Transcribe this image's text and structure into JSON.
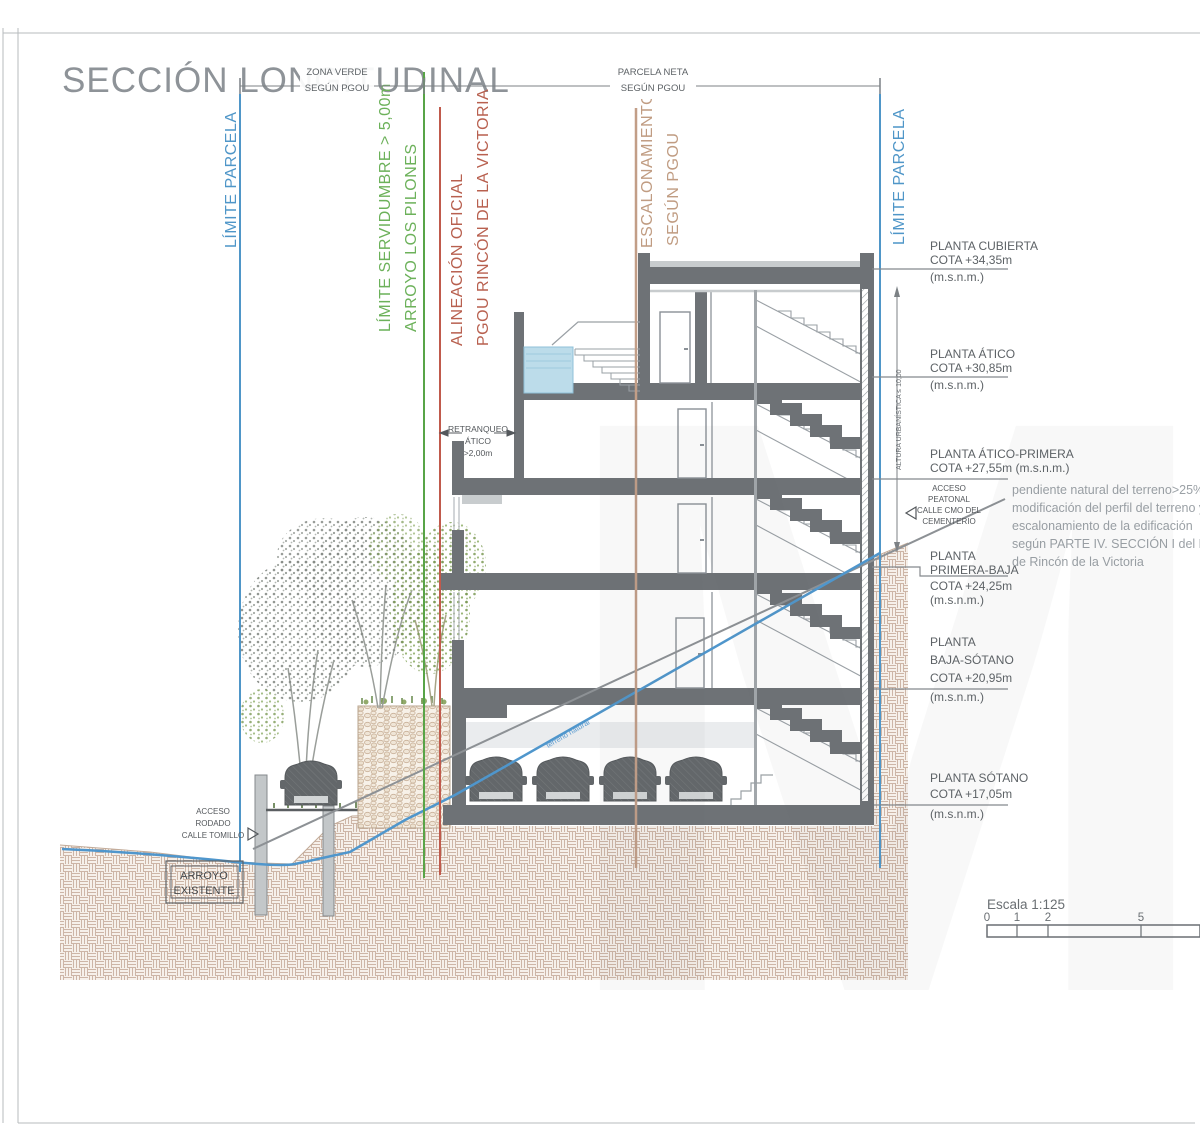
{
  "title": "SECCIÓN LONGITUDINAL",
  "boundaries": {
    "limite_parcela_left": "LÍMITE PARCELA",
    "limite_servidumbre": "LÍMITE SERVIDUMBRE > 5,00m",
    "arroyo_los_pilones": "ARROYO LOS PILONES",
    "alineacion_oficial": "ALINEACIÓN OFICIAL",
    "pgou_rincon": "PGOU RINCÓN DE LA VICTORIA",
    "escalonamiento": "ESCALONAMIENTO",
    "escalonamiento_segun": "SEGÚN PGOU",
    "limite_parcela_right": "LÍMITE PARCELA"
  },
  "dim": {
    "zona_verde": [
      "ZONA VERDE",
      "SEGÚN PGOU"
    ],
    "parcela_neta": [
      "PARCELA NETA",
      "SEGÚN PGOU"
    ],
    "altura": "ALTURA URBANÍSTICA ≤ 10,00",
    "retranqueo": [
      "RETRANQUEO",
      "ÁTICO",
      ">2,00m"
    ]
  },
  "levels": [
    {
      "lines": [
        "PLANTA CUBIERTA",
        "COTA +34,35m"
      ],
      "msnm": "(m.s.n.m.)"
    },
    {
      "lines": [
        "PLANTA ÁTICO",
        "COTA +30,85m"
      ],
      "msnm": "(m.s.n.m.)"
    },
    {
      "lines": [
        "PLANTA ÁTICO-PRIMERA",
        "COTA +27,55m (m.s.n.m.)"
      ],
      "msnm": ""
    },
    {
      "lines": [
        "PLANTA",
        "PRIMERA-BAJA",
        "COTA +24,25m"
      ],
      "msnm": "(m.s.n.m.)"
    },
    {
      "lines": [
        "PLANTA",
        "BAJA-SÓTANO",
        "COTA +20,95m"
      ],
      "msnm": "(m.s.n.m.)"
    },
    {
      "lines": [
        "PLANTA SÓTANO",
        "COTA +17,05m"
      ],
      "msnm": "(m.s.n.m.)"
    }
  ],
  "annotations": {
    "acceso_peatonal": [
      "ACCESO",
      "PEATONAL",
      "CALLE CMO DEL",
      "CEMENTERIO"
    ],
    "acceso_rodado": [
      "ACCESO",
      "RODADO",
      "CALLE TOMILLO"
    ],
    "arroyo_existente": [
      "ARROYO",
      "EXISTENTE"
    ],
    "terreno_natural": "terreno natural",
    "note": [
      "pendiente natural  del terreno>25%",
      "modificación del perfil del terreno y",
      "escalonamiento de la edificación",
      "según PARTE IV. SECCIÓN I del PGOU",
      "de Rincón de la Victoria"
    ]
  },
  "scalebar": {
    "label": "Escala 1:125",
    "t0": "0",
    "t1": "1",
    "t2": "2",
    "t5": "5"
  },
  "colors": {
    "limit_blue": "#4f96c8",
    "servidumbre_green": "#58a447",
    "alineacion_red": "#c05a4c",
    "escalonamiento_tan": "#c29e87",
    "water_blue": "#bcdcea",
    "earth_hatch_line": "#cdb5a6",
    "slab_gray": "#6e7276"
  }
}
